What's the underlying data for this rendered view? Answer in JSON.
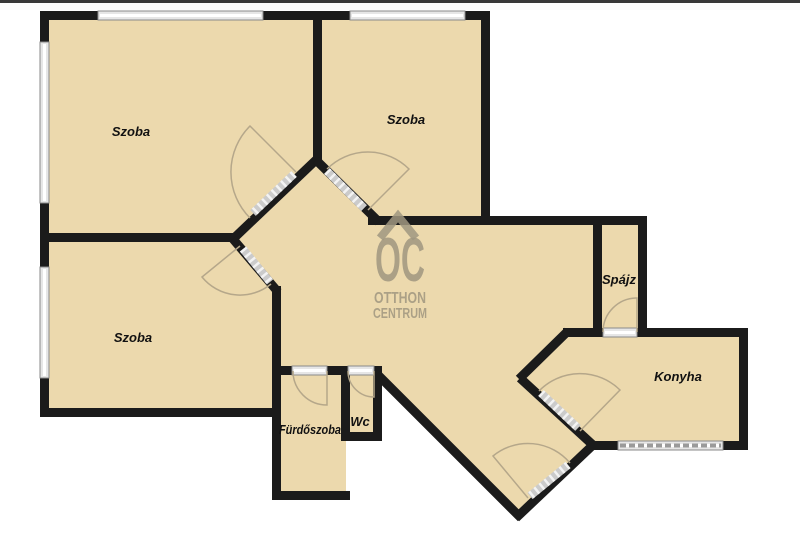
{
  "theme": {
    "background": "#ffffff",
    "floor": "#ecd9ad",
    "wall": "#1b1b1b",
    "top_bar": "#3a3a3a",
    "window_fill": "#e6e6e6",
    "window_border": "#8a8a8a",
    "hatch": "#cbcbcb",
    "arc": "#b5a78a",
    "watermark": "#a09780",
    "label": "#111111"
  },
  "floorplan": {
    "rooms": [
      {
        "id": "szoba-1",
        "label": "Szoba"
      },
      {
        "id": "szoba-2",
        "label": "Szoba"
      },
      {
        "id": "szoba-3",
        "label": "Szoba"
      },
      {
        "id": "spajz",
        "label": "Spájz"
      },
      {
        "id": "konyha",
        "label": "Konyha"
      },
      {
        "id": "furdoszoba",
        "label": "Fürdőszoba"
      },
      {
        "id": "wc",
        "label": "Wc"
      }
    ],
    "watermark": {
      "logo": "OC",
      "line1": "OTTHON",
      "line2": "CENTRUM"
    }
  }
}
